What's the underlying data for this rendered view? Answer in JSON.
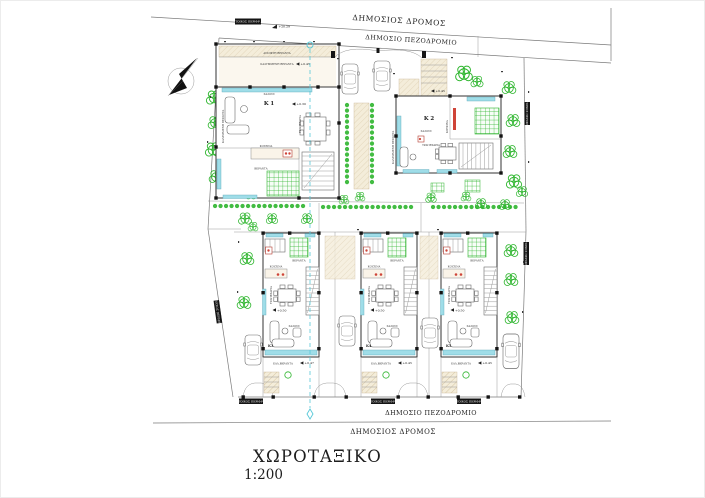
{
  "drawing": {
    "title": "ΧΩΡΟΤΑΞΙΚΟ",
    "scale": "1:200"
  },
  "streets": {
    "top_road": "ΔΗΜΟΣΙΟΣ ΔΡΟΜΟΣ",
    "top_sidewalk": "ΔΗΜΟΣΙΟ ΠΕΖΟΔΡΟΜΙΟ",
    "bottom_sidewalk": "ΔΗΜΟΣΙΟ ΠΕΖΟΔΡΟΜΙΟ",
    "bottom_road": "ΔΗΜΟΣΙΟΣ ΔΡΟΜΟΣ"
  },
  "boundary": {
    "wall_label": "ΤΟΙΧΟΣ ΠΕΡΙΦΡ."
  },
  "levels": {
    "street": "+20.29",
    "k1_floor": "+0.30",
    "k1_veranda": "+0.45",
    "k2_entry": "+0.45",
    "floor": "+0.50",
    "k3_veranda": "+0.47",
    "k4_veranda": "+0.45",
    "k5_veranda": "+0.45"
  },
  "buildings": {
    "k1": {
      "id": "K 1",
      "living": "ΣΑΛΟΝΙ",
      "kitchen": "ΚΟΥΖΙΝΑ",
      "dining": "ΤΡΑΠΕΖΑΡΙΑ",
      "veranda": "ΒΕΡΑΝΤΑ",
      "open_veranda": "ΑΝΟΙΚΤΗ ΒΕΡΑΝΤΑ",
      "covered_veranda": "ΚΑΛΥΜΜΕΝΗ ΒΕΡΑΝΤΑ"
    },
    "k2": {
      "id": "K 2",
      "living": "ΣΑΛΟΝΙ",
      "kitchen": "ΚΟΥΖΙΝΑ",
      "dining": "ΤΡΑΠΕΖΑΡΙΑ",
      "covered_veranda": "ΚΑΛΥΜΜΕΝΗ ΒΕΡΑΝΤΑ"
    },
    "rowhouse": {
      "living": "ΣΑΛΟΝΙ",
      "kitchen": "ΚΟΥΖΙΝΑ",
      "dining": "ΤΡΑΠΕΖΑΡΙΑ",
      "veranda": "ΒΕΡΑΝΤΑ",
      "covered_veranda": "ΚΑΛ.ΒΕΡΑΝΤΑ"
    },
    "k3": {
      "id": "K3"
    },
    "k4": {
      "id": "K4"
    },
    "k5": {
      "id": "K5"
    }
  },
  "colors": {
    "vegetation": "#2db52d",
    "glazing": "#9fdde8",
    "walkway_hatch": "#f4edda",
    "accent_red": "#cf4438",
    "wall": "#1a1a1a",
    "line": "#7a7a7a",
    "centerline": "#57c8d8"
  }
}
